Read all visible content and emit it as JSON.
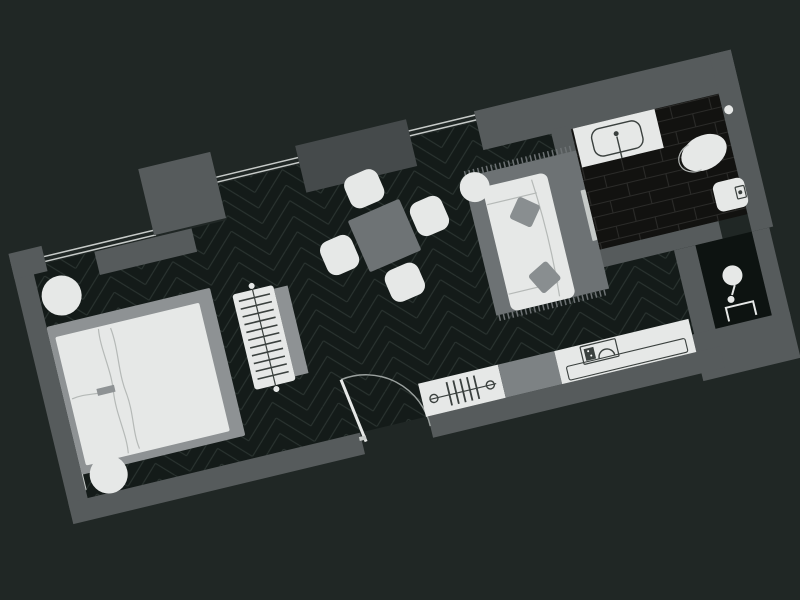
{
  "scene": {
    "type": "apartment-floor-plan",
    "style": "dark",
    "rotation_deg": -13.5,
    "visible_text": []
  },
  "colors": {
    "bg": "#202725",
    "wall": "#565b5c",
    "planter": "#454a4b",
    "floor_base": "#141b19",
    "floor_line": "#2b3431",
    "bath_base": "#121210",
    "bath_line": "#2b2b29",
    "shower_base": "#0d1311",
    "furn_light": "#e6e8e7",
    "furn_mid": "#8e9294",
    "furn_gray": "#6e7375",
    "rug": "#6d7274",
    "module": "#7d8284",
    "pillow": "#898e90",
    "glass": "#c6cac8",
    "soft_line": "#b5b9b7",
    "dark_line": "#3a403e",
    "arc": "#9aa09e"
  },
  "rooms": [
    {
      "id": "bedroom",
      "floor_pattern": "herringbone",
      "furniture": [
        "double-bed",
        "bedside-table",
        "bedside-table",
        "luggage-bench",
        "side-console"
      ]
    },
    {
      "id": "living-dining",
      "floor_pattern": "herringbone",
      "furniture": [
        "dining-table",
        "dining-chair",
        "dining-chair",
        "dining-chair",
        "dining-chair",
        "round-side-table",
        "sofa",
        "rug",
        "throw-pillow",
        "throw-pillow",
        "window-planter"
      ]
    },
    {
      "id": "kitchenette",
      "floor_pattern": "herringbone",
      "furniture": [
        "radiator-panel",
        "cooktop-module",
        "counter-with-sink",
        "base-cabinet"
      ]
    },
    {
      "id": "bathroom",
      "floor_pattern": "brick-tile",
      "fixtures": [
        "vanity-sink",
        "toilet",
        "bidet",
        "wall-light"
      ]
    },
    {
      "id": "shower-room",
      "floor_pattern": "dark-tile",
      "fixtures": [
        "shower-head"
      ]
    }
  ],
  "openings": {
    "entry_doors": 1,
    "bathroom_doors": 1,
    "window_sections": 3
  }
}
